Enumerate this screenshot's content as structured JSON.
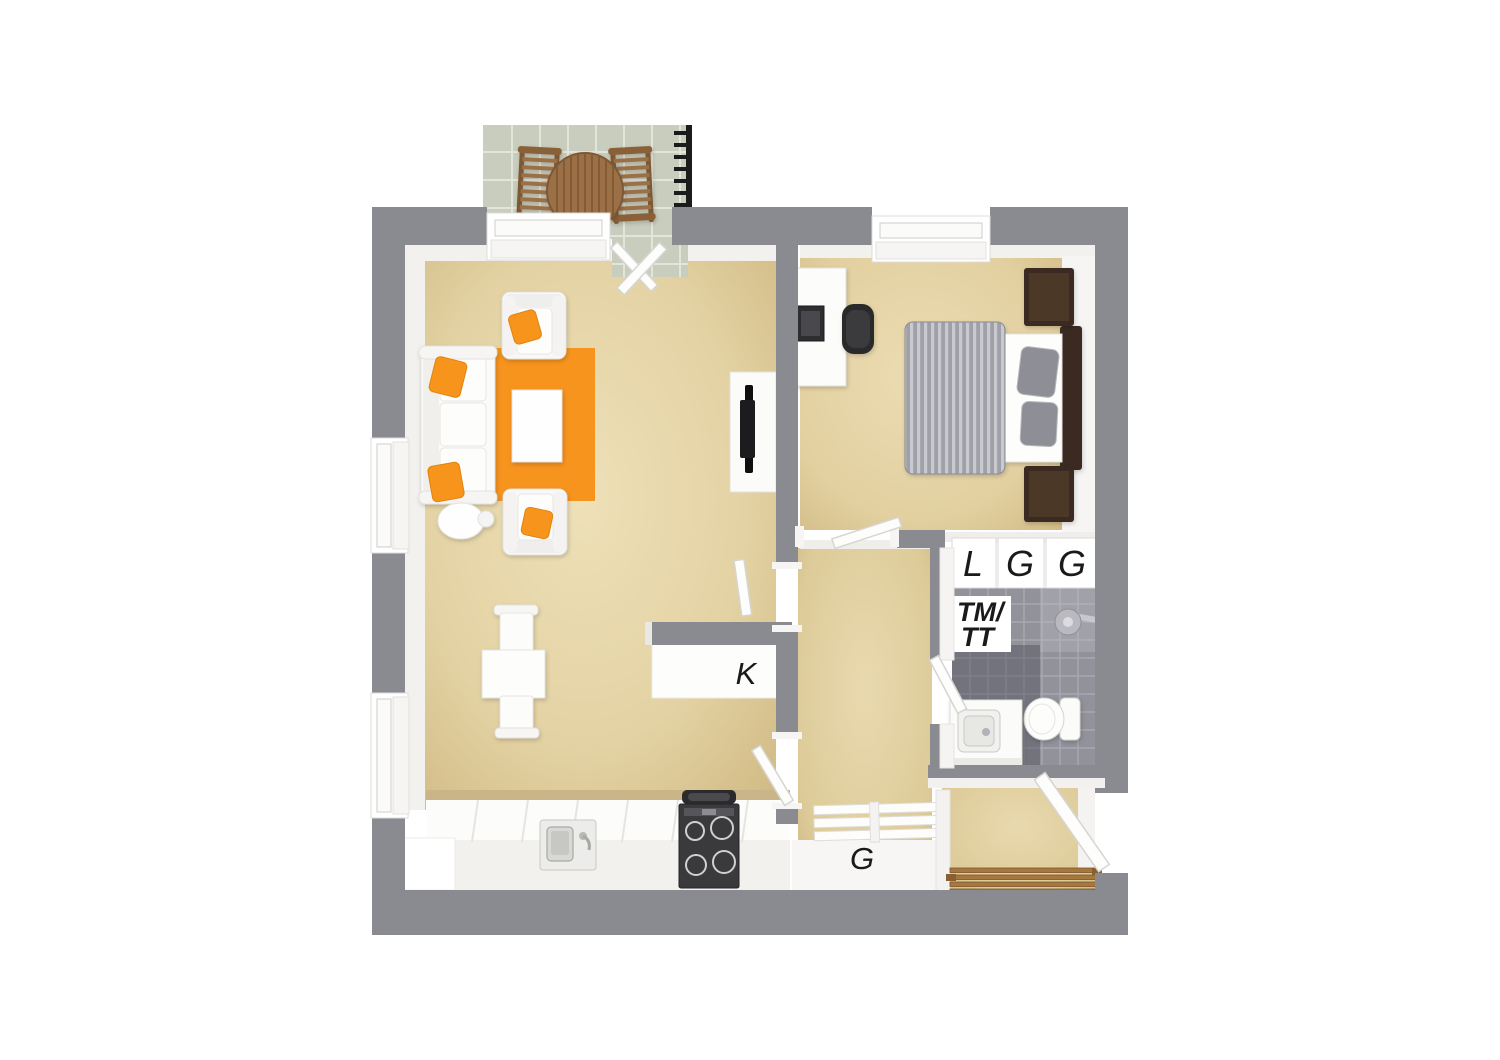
{
  "scene": {
    "type": "3d-floor-plan-top-view",
    "description": "3D top-down floor plan of a one-bedroom apartment with balcony, living room, bedroom, bathroom and entrance hall"
  },
  "palette": {
    "background": "#ffffff",
    "wall_gray": "#8a8a91",
    "floor_beige": "#e5d5a9",
    "floor_beige_shade": "#cdb680",
    "balcony_tile_green": "#c8cdbd",
    "bathroom_tile_gray": "#92929b",
    "accent_orange": "#f7941e",
    "wood_brown": "#9b6f46",
    "dark_wood_brown": "#3a2a20",
    "bed_textile_gray": "#9fa0a8",
    "white_surface": "#fbfbfa",
    "label_text": "#1a1a1a"
  },
  "labels": {
    "kitchen": "K",
    "entrance_closet": "G",
    "closet_row": [
      "L",
      "G",
      "G"
    ],
    "bathroom_line1": "TM/",
    "bathroom_line2": "TT"
  }
}
